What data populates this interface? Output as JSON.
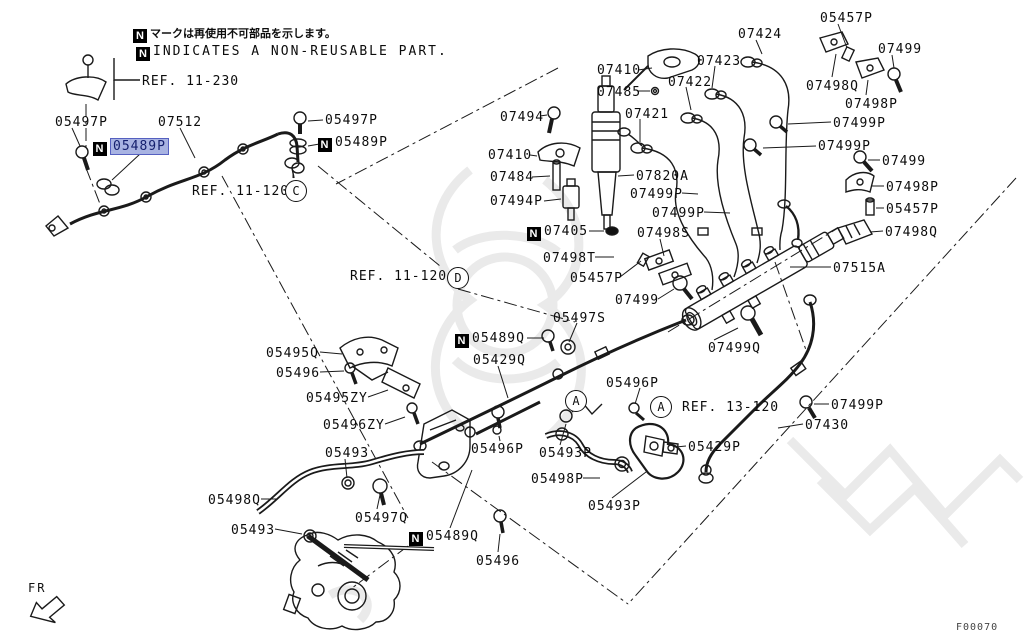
{
  "page": {
    "background": "#ffffff",
    "diagram_code": "F00070",
    "fr_label": "FR"
  },
  "notes": {
    "badge": "N",
    "jp": "マークは再使用不可部品を示します。",
    "en": "INDICATES A NON-REUSABLE PART."
  },
  "highlight": {
    "bg": "#a8b3e2",
    "border": "#5560c0",
    "text_color": "#15206e"
  },
  "refs": [
    {
      "text": "REF. 11-230",
      "x": 142,
      "y": 74
    },
    {
      "text": "REF. 11-120",
      "x": 192,
      "y": 184,
      "circle": "C",
      "cx": 285,
      "cy": 180
    },
    {
      "text": "REF. 11-120",
      "x": 350,
      "y": 269,
      "circle": "D",
      "cx": 447,
      "cy": 267
    },
    {
      "text": "REF. 13-120",
      "x": 682,
      "y": 400,
      "circle": "A",
      "cx": 650,
      "cy": 396
    },
    {
      "circle": "A",
      "cx": 565,
      "cy": 390
    }
  ],
  "labels": [
    {
      "t": "05497P",
      "x": 55,
      "y": 115
    },
    {
      "t": "07512",
      "x": 158,
      "y": 115
    },
    {
      "t": "05489P",
      "x": 93,
      "y": 139,
      "n": true,
      "hl": true
    },
    {
      "t": "05497P",
      "x": 325,
      "y": 113
    },
    {
      "t": "05489P",
      "x": 318,
      "y": 135,
      "n": true
    },
    {
      "t": "07410",
      "x": 597,
      "y": 63
    },
    {
      "t": "07485",
      "x": 597,
      "y": 85
    },
    {
      "t": "07494",
      "x": 500,
      "y": 110
    },
    {
      "t": "07424",
      "x": 738,
      "y": 27
    },
    {
      "t": "07423",
      "x": 697,
      "y": 54
    },
    {
      "t": "07422",
      "x": 668,
      "y": 75
    },
    {
      "t": "07421",
      "x": 625,
      "y": 107
    },
    {
      "t": "05457P",
      "x": 820,
      "y": 11
    },
    {
      "t": "07499",
      "x": 878,
      "y": 42
    },
    {
      "t": "07498Q",
      "x": 806,
      "y": 79
    },
    {
      "t": "07498P",
      "x": 845,
      "y": 97
    },
    {
      "t": "07499P",
      "x": 833,
      "y": 116
    },
    {
      "t": "07499P",
      "x": 818,
      "y": 139
    },
    {
      "t": "07499",
      "x": 882,
      "y": 154
    },
    {
      "t": "07410",
      "x": 488,
      "y": 148
    },
    {
      "t": "07484",
      "x": 490,
      "y": 170
    },
    {
      "t": "07494P",
      "x": 490,
      "y": 194
    },
    {
      "t": "07405",
      "x": 527,
      "y": 224,
      "n": true
    },
    {
      "t": "07820A",
      "x": 636,
      "y": 169
    },
    {
      "t": "07499P",
      "x": 630,
      "y": 187
    },
    {
      "t": "07499P",
      "x": 652,
      "y": 206
    },
    {
      "t": "07498S",
      "x": 637,
      "y": 226
    },
    {
      "t": "07498T",
      "x": 543,
      "y": 251
    },
    {
      "t": "05457P",
      "x": 570,
      "y": 271
    },
    {
      "t": "07499",
      "x": 615,
      "y": 293
    },
    {
      "t": "07515A",
      "x": 833,
      "y": 261
    },
    {
      "t": "07498P",
      "x": 886,
      "y": 180
    },
    {
      "t": "05457P",
      "x": 886,
      "y": 202
    },
    {
      "t": "07498Q",
      "x": 885,
      "y": 225
    },
    {
      "t": "05497S",
      "x": 553,
      "y": 311
    },
    {
      "t": "05489Q",
      "x": 455,
      "y": 331,
      "n": true
    },
    {
      "t": "05429Q",
      "x": 473,
      "y": 353
    },
    {
      "t": "07499Q",
      "x": 708,
      "y": 341
    },
    {
      "t": "05495Q",
      "x": 266,
      "y": 346
    },
    {
      "t": "05496",
      "x": 276,
      "y": 366
    },
    {
      "t": "05495ZY",
      "x": 306,
      "y": 391
    },
    {
      "t": "05496ZY",
      "x": 323,
      "y": 418
    },
    {
      "t": "05493",
      "x": 325,
      "y": 446
    },
    {
      "t": "05496P",
      "x": 606,
      "y": 376
    },
    {
      "t": "05496P",
      "x": 471,
      "y": 442
    },
    {
      "t": "05493P",
      "x": 539,
      "y": 446
    },
    {
      "t": "05498P",
      "x": 531,
      "y": 472
    },
    {
      "t": "05493P",
      "x": 588,
      "y": 499
    },
    {
      "t": "05429P",
      "x": 688,
      "y": 440
    },
    {
      "t": "07499P",
      "x": 831,
      "y": 398
    },
    {
      "t": "07430",
      "x": 805,
      "y": 418
    },
    {
      "t": "05498Q",
      "x": 208,
      "y": 493
    },
    {
      "t": "05493",
      "x": 231,
      "y": 523
    },
    {
      "t": "05497Q",
      "x": 355,
      "y": 511
    },
    {
      "t": "05489Q",
      "x": 409,
      "y": 529,
      "n": true
    },
    {
      "t": "05496",
      "x": 476,
      "y": 554
    }
  ]
}
